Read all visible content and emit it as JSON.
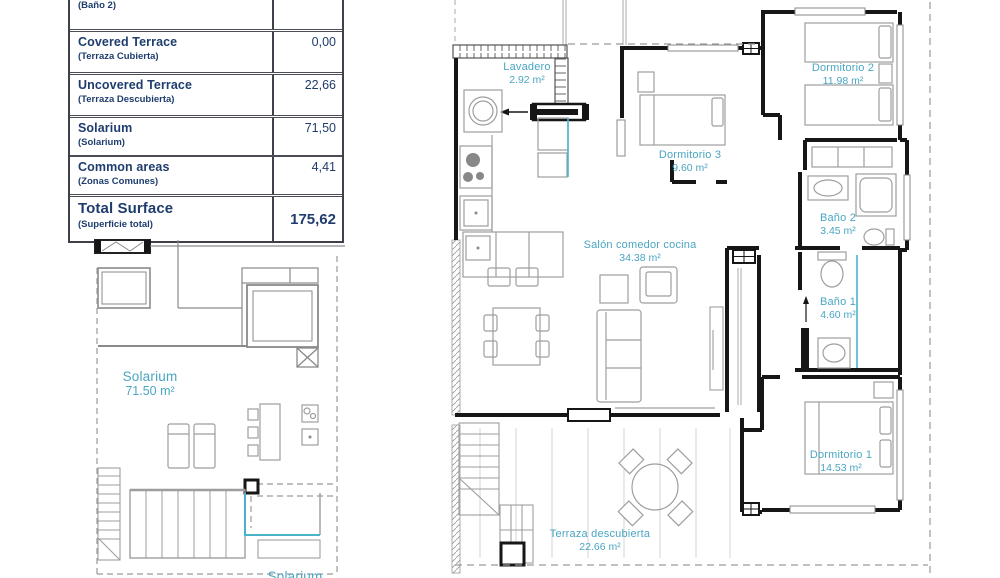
{
  "surface_table": {
    "rows": [
      {
        "label_en": "Bathroom 2",
        "label_es": "(Baño 2)",
        "value": "3,45"
      },
      {
        "label_en": "Covered Terrace",
        "label_es": "(Terraza Cubierta)",
        "value": "0,00"
      },
      {
        "label_en": "Uncovered Terrace",
        "label_es": "(Terraza Descubierta)",
        "value": "22,66"
      },
      {
        "label_en": "Solarium",
        "label_es": "(Solarium)",
        "value": "71,50"
      },
      {
        "label_en": "Common areas",
        "label_es": "(Zonas Comunes)",
        "value": "4,41"
      }
    ],
    "total": {
      "label_en": "Total Surface",
      "label_es": "(Superficie total)",
      "value": "175,62"
    }
  },
  "solarium_plan": {
    "room_label": {
      "name": "Solarium",
      "area": "71.50 m²"
    },
    "bottom_label": {
      "name": "Solarium"
    }
  },
  "apartment_plan": {
    "rooms": {
      "lavadero": {
        "name": "Lavadero",
        "area": "2.92 m²"
      },
      "dormitorio3": {
        "name": "Dormitorio 3",
        "area": "9.60 m²"
      },
      "dormitorio2": {
        "name": "Dormitorio 2",
        "area": "11.98 m²"
      },
      "bano2": {
        "name": "Baño 2",
        "area": "3.45 m²"
      },
      "bano1": {
        "name": "Baño 1",
        "area": "4.60 m²"
      },
      "salon": {
        "name": "Salón comedor cocina",
        "area": "34.38 m²"
      },
      "dormitorio1": {
        "name": "Dormitorio 1",
        "area": "14.53 m²"
      },
      "terraza": {
        "name": "Terraza descubierta",
        "area": "22.66 m²"
      }
    }
  },
  "colors": {
    "accent_teal": "#4aa6c2",
    "table_navy": "#1e3d6e",
    "wall_black": "#161616"
  }
}
